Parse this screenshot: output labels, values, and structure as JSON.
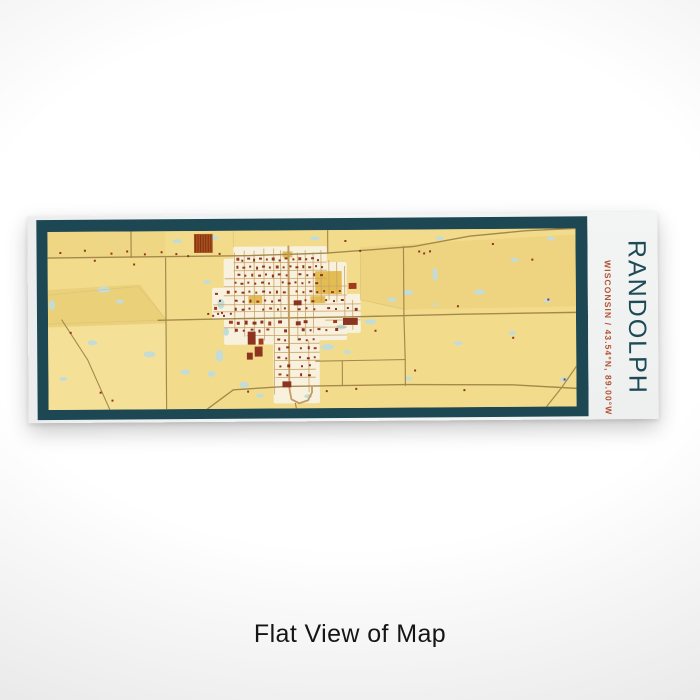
{
  "product": {
    "title": "RANDOLPH",
    "subtitle": "WISCONSIN / 43.54°N, 89.00°W",
    "caption": "Flat View of Map"
  },
  "colors": {
    "frame": "#1d4752",
    "mapBg": "#f2dc8c",
    "town": "#f8f1de",
    "mustard": "#e3bc52",
    "water": "#c3dcd8",
    "road": "#a5894c",
    "street": "#c9a468",
    "mainStreet": "#c49a5e",
    "boundary": "#dcc279",
    "fieldDark": "#e3c468",
    "fieldLight": "#f9ecb4",
    "building": "#8d3420",
    "building2": "#a23b1c",
    "orchard": "#a8511f",
    "orchardStripe": "#7e3210",
    "title": "#1d4a55",
    "subtitle": "#b5502f",
    "caption": "#151515"
  },
  "map_art": {
    "viewBox": "48 230 537 178",
    "fields": [
      {
        "pts": "48,288 142,283 168,318 168,322 48,325",
        "o": 0.5,
        "light": false
      },
      {
        "pts": "366,247 585,236 585,308 412,310 366,300",
        "o": 0.3,
        "light": false
      },
      {
        "pts": "48,230 168,230 168,256 48,256",
        "o": 0.22,
        "light": false
      },
      {
        "pts": "48,326 168,322 168,408 48,408",
        "o": 0.3,
        "light": true
      }
    ],
    "town": [
      [
        237,
        246,
        95,
        42
      ],
      [
        227,
        258,
        76,
        86
      ],
      [
        300,
        262,
        52,
        78
      ],
      [
        330,
        294,
        36,
        39
      ],
      [
        277,
        335,
        47,
        68
      ],
      [
        215,
        287,
        21,
        32
      ]
    ],
    "mustard": [
      [
        320,
        271,
        27,
        23
      ],
      [
        315,
        296,
        15,
        7
      ],
      [
        252,
        295,
        14,
        8
      ],
      [
        287,
        251,
        10,
        6
      ]
    ],
    "water": [
      [
        105,
        288,
        7,
        3
      ],
      [
        121,
        300,
        4,
        2
      ],
      [
        93,
        341,
        5,
        2.5
      ],
      [
        63,
        377,
        4,
        2
      ],
      [
        151,
        353,
        6,
        3
      ],
      [
        187,
        371,
        5,
        2.5
      ],
      [
        52,
        303,
        3,
        5
      ],
      [
        180,
        240,
        5,
        2
      ],
      [
        218,
        237,
        4,
        2
      ],
      [
        320,
        238,
        5,
        2
      ],
      [
        210,
        281,
        4,
        2
      ],
      [
        224,
        303,
        3.5,
        5
      ],
      [
        229,
        331,
        3,
        4
      ],
      [
        222,
        355,
        4,
        6
      ],
      [
        214,
        373,
        4,
        3
      ],
      [
        247,
        384,
        5,
        3
      ],
      [
        263,
        395,
        4,
        2
      ],
      [
        332,
        347,
        7,
        3
      ],
      [
        352,
        352,
        4,
        2
      ],
      [
        376,
        322,
        6,
        2.5
      ],
      [
        398,
        300,
        5,
        2
      ],
      [
        414,
        293,
        6,
        2.5
      ],
      [
        442,
        275,
        2.5,
        7
      ],
      [
        487,
        293,
        6,
        2.5
      ],
      [
        442,
        305,
        2,
        1.5
      ],
      [
        465,
        344,
        5,
        2
      ],
      [
        520,
        334,
        4,
        2
      ],
      [
        556,
        302,
        4,
        2
      ],
      [
        573,
        381,
        5,
        2.5
      ],
      [
        523,
        261,
        4,
        2
      ],
      [
        447,
        239,
        4,
        2
      ],
      [
        414,
        379,
        4,
        2
      ],
      [
        312,
        396,
        4,
        2
      ],
      [
        346,
        327,
        5,
        2.5
      ],
      [
        560,
        240,
        4,
        2
      ]
    ],
    "boundaries": [
      "48,293 140,285 168,318",
      "48,322 160,319",
      "366,250 366,300 412,310",
      "237,230 237,246"
    ],
    "streets": [
      "238,252 238,332",
      "248,250 248,336",
      "258,250 258,340",
      "268,248 268,340",
      "278,248 278,394",
      "285,250 285,318",
      "302,252 302,340",
      "310,250 310,336",
      "318,252 318,333",
      "326,250 326,302",
      "334,260 334,300",
      "342,262 342,302",
      "350,266 350,318",
      "358,300 358,330",
      "313,340 313,392",
      "237,262 332,262",
      "237,270 332,270",
      "228,278 332,278",
      "227,286 352,286",
      "227,295 352,295",
      "216,304 366,304",
      "216,311 366,311",
      "227,327 352,327",
      "250,335 352,335",
      "278,343 324,343",
      "278,352 324,352",
      "278,360 324,360",
      "278,369 320,369",
      "279,377 320,377",
      "330,320 366,320"
    ],
    "roads": [
      {
        "p": "48,256 250,255 332,253 420,247 478,237 535,232 585,230",
        "w": 1.4,
        "c": "road"
      },
      {
        "p": "160,319 230,318 352,317 470,315 585,314",
        "w": 1.4,
        "c": "road"
      },
      {
        "p": "410,247 410,316 411,360 411,386",
        "w": 1.2,
        "c": "road"
      },
      {
        "p": "168,257 168,318 168,410",
        "w": 1.2,
        "c": "road"
      },
      {
        "p": "133,230 133,256",
        "w": 1.2,
        "c": "road"
      },
      {
        "p": "333,230 333,253",
        "w": 1.2,
        "c": "road"
      },
      {
        "p": "204,412 236,389 290,386 411,385 520,386 585,390",
        "w": 1.4,
        "c": "road"
      },
      {
        "p": "552,411 570,389 585,368",
        "w": 1.2,
        "c": "road"
      },
      {
        "p": "320,361 411,360",
        "w": 1.1,
        "c": "road"
      },
      {
        "p": "347,361 347,385",
        "w": 1.1,
        "c": "road"
      },
      {
        "p": "62,318 88,358 112,412",
        "w": 1.1,
        "c": "road"
      },
      {
        "p": "293,246 293,318",
        "w": 2,
        "c": "mainStreet"
      },
      {
        "p": "293,318 293,360 293,388 295,399 303,403 312,400 316,392 316,386",
        "w": 1.8,
        "c": "mainStreet"
      },
      {
        "p": "299,403 300,408",
        "w": 1.2,
        "c": "road"
      }
    ],
    "orchard": {
      "x": 197,
      "y": 233,
      "w": 19,
      "h": 19,
      "stripeStep": 2.6
    },
    "buildings": [
      [
        240,
        257,
        3,
        3
      ],
      [
        245,
        259,
        2,
        2
      ],
      [
        251,
        257,
        3,
        2
      ],
      [
        257,
        258,
        2,
        3
      ],
      [
        263,
        257,
        3,
        2
      ],
      [
        270,
        258,
        2,
        2
      ],
      [
        276,
        257,
        3,
        3
      ],
      [
        283,
        259,
        2,
        2
      ],
      [
        289,
        257,
        3,
        2
      ],
      [
        297,
        258,
        2,
        2
      ],
      [
        303,
        257,
        3,
        3
      ],
      [
        310,
        258,
        2,
        2
      ],
      [
        316,
        257,
        3,
        2
      ],
      [
        322,
        259,
        2,
        2
      ],
      [
        240,
        265,
        2,
        3
      ],
      [
        246,
        266,
        3,
        2
      ],
      [
        253,
        265,
        2,
        2
      ],
      [
        260,
        266,
        2,
        3
      ],
      [
        266,
        265,
        3,
        2
      ],
      [
        273,
        266,
        2,
        2
      ],
      [
        280,
        265,
        3,
        3
      ],
      [
        287,
        266,
        2,
        2
      ],
      [
        294,
        265,
        2,
        2
      ],
      [
        300,
        266,
        3,
        2
      ],
      [
        307,
        265,
        2,
        3
      ],
      [
        313,
        266,
        3,
        2
      ],
      [
        320,
        265,
        2,
        2
      ],
      [
        326,
        266,
        2,
        2
      ],
      [
        241,
        273,
        3,
        2
      ],
      [
        248,
        274,
        2,
        2
      ],
      [
        255,
        273,
        2,
        3
      ],
      [
        262,
        274,
        3,
        2
      ],
      [
        269,
        273,
        2,
        2
      ],
      [
        276,
        274,
        2,
        3
      ],
      [
        282,
        273,
        3,
        2
      ],
      [
        290,
        274,
        2,
        2
      ],
      [
        303,
        273,
        3,
        2
      ],
      [
        311,
        274,
        2,
        2
      ],
      [
        318,
        273,
        2,
        3
      ],
      [
        325,
        274,
        3,
        2
      ],
      [
        238,
        281,
        2,
        2
      ],
      [
        244,
        282,
        3,
        2
      ],
      [
        251,
        281,
        2,
        2
      ],
      [
        258,
        282,
        2,
        2
      ],
      [
        265,
        281,
        3,
        2
      ],
      [
        272,
        282,
        2,
        2
      ],
      [
        286,
        281,
        2,
        2
      ],
      [
        292,
        282,
        3,
        2
      ],
      [
        299,
        281,
        2,
        2
      ],
      [
        306,
        282,
        2,
        2
      ],
      [
        313,
        281,
        2,
        2
      ],
      [
        320,
        282,
        3,
        2
      ],
      [
        230,
        290,
        3,
        3
      ],
      [
        218,
        292,
        3,
        2
      ],
      [
        222,
        299,
        2,
        2
      ],
      [
        217,
        306,
        3,
        3
      ],
      [
        224,
        311,
        2,
        2
      ],
      [
        238,
        290,
        2,
        2
      ],
      [
        245,
        291,
        3,
        2
      ],
      [
        252,
        290,
        2,
        2
      ],
      [
        259,
        291,
        2,
        2
      ],
      [
        266,
        290,
        3,
        2
      ],
      [
        273,
        291,
        2,
        2
      ],
      [
        280,
        290,
        2,
        3
      ],
      [
        287,
        291,
        3,
        2
      ],
      [
        300,
        290,
        2,
        2
      ],
      [
        307,
        291,
        2,
        2
      ],
      [
        314,
        290,
        3,
        2
      ],
      [
        321,
        291,
        2,
        2
      ],
      [
        328,
        290,
        2,
        2
      ],
      [
        336,
        291,
        3,
        2
      ],
      [
        344,
        290,
        2,
        2
      ],
      [
        238,
        299,
        3,
        2
      ],
      [
        246,
        300,
        2,
        2
      ],
      [
        253,
        299,
        2,
        3
      ],
      [
        260,
        300,
        3,
        2
      ],
      [
        268,
        299,
        2,
        2
      ],
      [
        275,
        300,
        2,
        2
      ],
      [
        282,
        299,
        3,
        2
      ],
      [
        298,
        300,
        8,
        5
      ],
      [
        309,
        299,
        2,
        2
      ],
      [
        316,
        300,
        3,
        2
      ],
      [
        330,
        299,
        2,
        2
      ],
      [
        338,
        300,
        2,
        2
      ],
      [
        346,
        299,
        3,
        2
      ],
      [
        354,
        283,
        8,
        6
      ],
      [
        238,
        307,
        2,
        3
      ],
      [
        245,
        308,
        3,
        2
      ],
      [
        252,
        307,
        2,
        2
      ],
      [
        266,
        308,
        2,
        2
      ],
      [
        273,
        307,
        3,
        2
      ],
      [
        281,
        308,
        2,
        2
      ],
      [
        288,
        307,
        2,
        2
      ],
      [
        302,
        308,
        3,
        2
      ],
      [
        310,
        307,
        2,
        2
      ],
      [
        318,
        308,
        2,
        2
      ],
      [
        332,
        307,
        3,
        2
      ],
      [
        340,
        308,
        2,
        2
      ],
      [
        352,
        307,
        2,
        2
      ],
      [
        360,
        308,
        3,
        3
      ],
      [
        232,
        320,
        4,
        3
      ],
      [
        240,
        321,
        3,
        3
      ],
      [
        248,
        320,
        3,
        4
      ],
      [
        256,
        321,
        4,
        3
      ],
      [
        264,
        320,
        3,
        3
      ],
      [
        272,
        321,
        3,
        4
      ],
      [
        282,
        320,
        4,
        3
      ],
      [
        300,
        321,
        5,
        4
      ],
      [
        308,
        320,
        4,
        3
      ],
      [
        348,
        318,
        15,
        7
      ],
      [
        338,
        320,
        4,
        3
      ],
      [
        238,
        328,
        3,
        3
      ],
      [
        246,
        329,
        2,
        2
      ],
      [
        254,
        328,
        3,
        2
      ],
      [
        262,
        329,
        2,
        3
      ],
      [
        270,
        328,
        3,
        2
      ],
      [
        288,
        329,
        3,
        3
      ],
      [
        306,
        328,
        3,
        3
      ],
      [
        314,
        329,
        2,
        2
      ],
      [
        322,
        328,
        3,
        2
      ],
      [
        330,
        329,
        2,
        2
      ],
      [
        340,
        328,
        3,
        3
      ],
      [
        251,
        331,
        8,
        13
      ],
      [
        258,
        346,
        8,
        10
      ],
      [
        250,
        352,
        6,
        7
      ],
      [
        262,
        338,
        5,
        6
      ],
      [
        281,
        338,
        3,
        2
      ],
      [
        288,
        339,
        2,
        2
      ],
      [
        302,
        338,
        3,
        2
      ],
      [
        310,
        339,
        2,
        2
      ],
      [
        317,
        338,
        2,
        2
      ],
      [
        282,
        347,
        2,
        3
      ],
      [
        290,
        346,
        3,
        2
      ],
      [
        304,
        347,
        2,
        2
      ],
      [
        312,
        346,
        2,
        3
      ],
      [
        318,
        347,
        3,
        2
      ],
      [
        281,
        356,
        3,
        2
      ],
      [
        289,
        357,
        2,
        2
      ],
      [
        303,
        356,
        2,
        2
      ],
      [
        311,
        357,
        3,
        2
      ],
      [
        318,
        356,
        2,
        2
      ],
      [
        283,
        365,
        2,
        2
      ],
      [
        291,
        364,
        3,
        3
      ],
      [
        305,
        365,
        2,
        2
      ],
      [
        313,
        364,
        2,
        2
      ],
      [
        282,
        373,
        3,
        2
      ],
      [
        290,
        374,
        2,
        2
      ],
      [
        304,
        373,
        2,
        3
      ],
      [
        312,
        374,
        3,
        2
      ],
      [
        286,
        381,
        9,
        6
      ]
    ],
    "farms": [
      [
        60,
        250
      ],
      [
        85,
        248
      ],
      [
        112,
        251
      ],
      [
        128,
        249
      ],
      [
        146,
        252
      ],
      [
        163,
        250
      ],
      [
        178,
        252
      ],
      [
        190,
        254
      ],
      [
        222,
        252
      ],
      [
        210,
        312
      ],
      [
        215,
        314
      ],
      [
        220,
        312
      ],
      [
        226,
        314
      ],
      [
        233,
        312
      ],
      [
        425,
        251
      ],
      [
        430,
        253
      ],
      [
        436,
        251
      ],
      [
        464,
        306
      ],
      [
        520,
        338
      ],
      [
        556,
        300
      ],
      [
        572,
        380
      ],
      [
        540,
        260
      ],
      [
        500,
        244
      ],
      [
        70,
        330
      ],
      [
        100,
        390
      ],
      [
        112,
        398
      ],
      [
        380,
        330
      ],
      [
        420,
        370
      ],
      [
        470,
        390
      ],
      [
        350,
        240
      ],
      [
        365,
        250
      ],
      [
        250,
        390
      ],
      [
        330,
        390
      ],
      [
        360,
        388
      ],
      [
        95,
        258
      ],
      [
        135,
        262
      ]
    ]
  }
}
